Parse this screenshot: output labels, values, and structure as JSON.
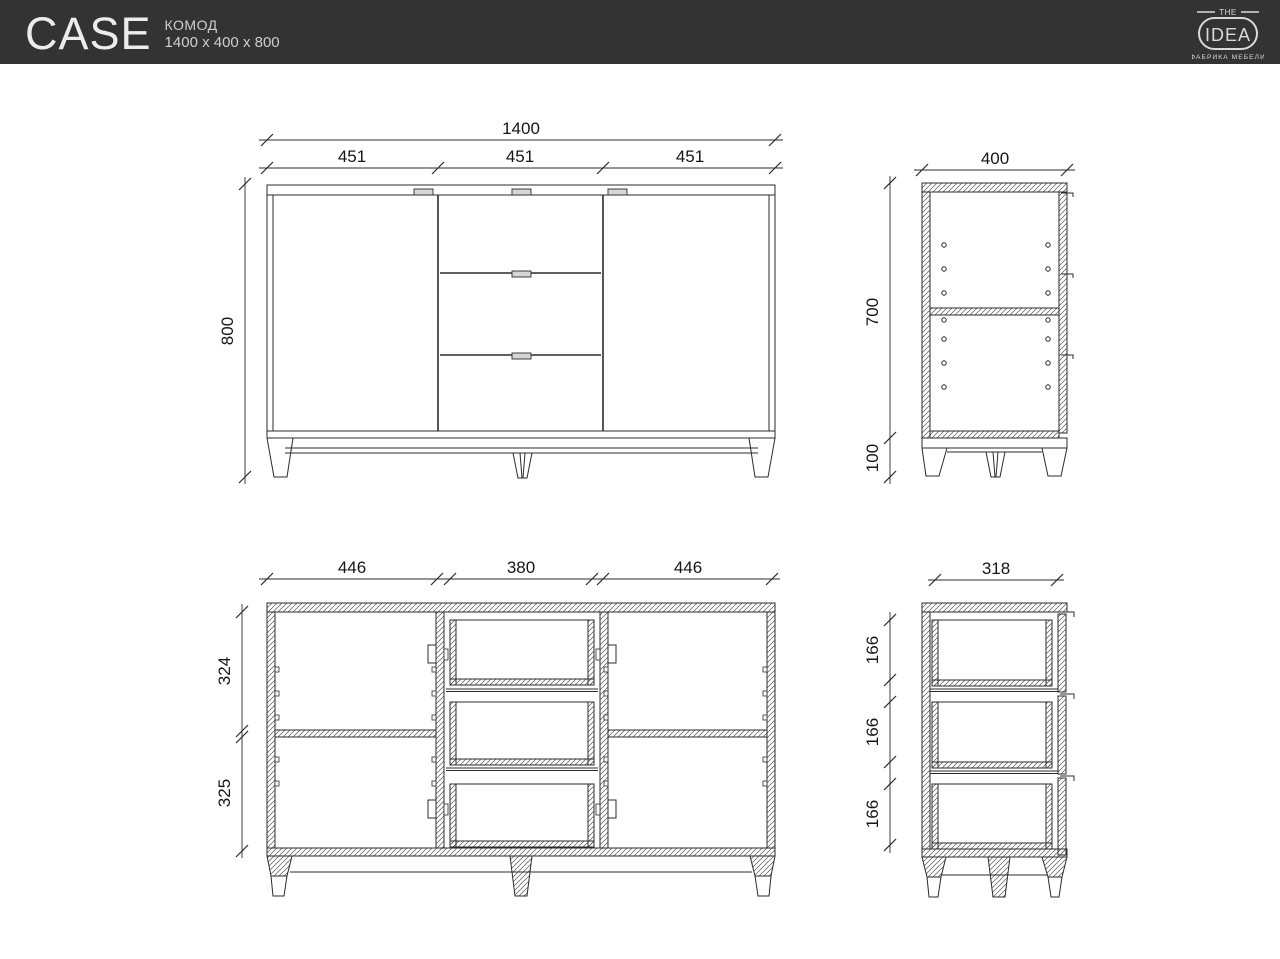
{
  "header": {
    "product_name": "CASE",
    "product_type": "КОМОД",
    "product_size": "1400 x 400 x 800"
  },
  "logo": {
    "top": "THE",
    "main": "IDEA",
    "bottom": "ФАБРИКА МЕБЕЛИ"
  },
  "colors": {
    "header_bg": "#333333",
    "header_text": "#ececec",
    "line": "#2b2b2b",
    "paper": "#ffffff"
  },
  "views": {
    "front": {
      "total_width": "1400",
      "section_widths": [
        "451",
        "451",
        "451"
      ],
      "height": "800"
    },
    "side": {
      "depth": "400",
      "body_height": "700",
      "leg_height": "100"
    },
    "front_section": {
      "left_width": "446",
      "center_width": "380",
      "right_width": "446",
      "upper_height": "324",
      "lower_height": "325"
    },
    "side_section": {
      "depth": "318",
      "drawer_heights": [
        "166",
        "166",
        "166"
      ]
    }
  }
}
